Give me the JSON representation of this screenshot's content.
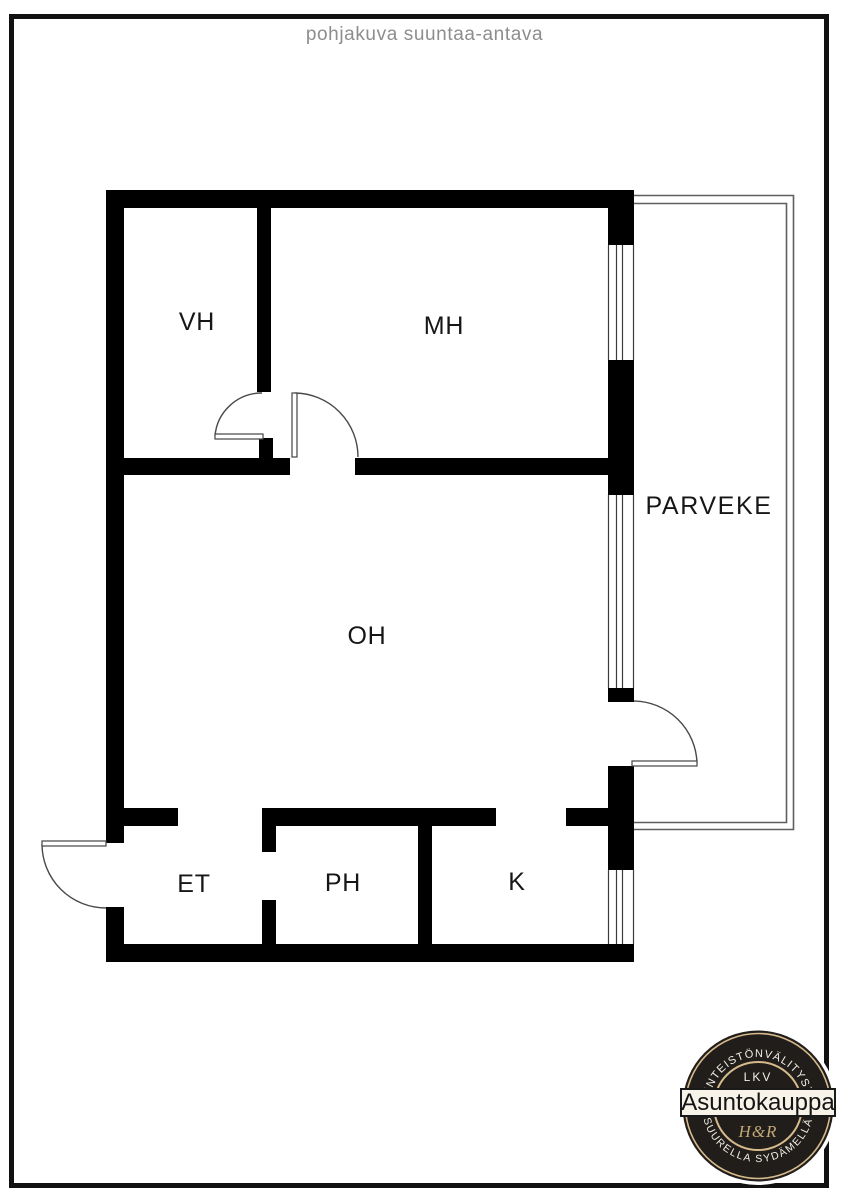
{
  "page": {
    "title": "pohjakuva suuntaa-antava"
  },
  "floorplan": {
    "rooms": [
      {
        "id": "vh",
        "label": "VH"
      },
      {
        "id": "mh",
        "label": "MH"
      },
      {
        "id": "oh",
        "label": "OH"
      },
      {
        "id": "parveke",
        "label": "PARVEKE"
      },
      {
        "id": "et",
        "label": "ET"
      },
      {
        "id": "ph",
        "label": "PH"
      },
      {
        "id": "k",
        "label": "K"
      }
    ]
  },
  "badge": {
    "arc_top": "KIINTEISTÖNVÄLITYSTÄ",
    "license": "LKV",
    "company": "Asuntokauppa",
    "monogram": "H&R",
    "arc_bottom": "SUURELLA SYDÄMELLÄ"
  },
  "colors": {
    "wall": "#000000",
    "title_text": "#8d8d8d",
    "frame": "#111111",
    "badge_background": "#201d1a",
    "badge_ring": "#d5ba8b",
    "badge_band": "#f8f3e9",
    "badge_monogram": "#c3a878"
  }
}
